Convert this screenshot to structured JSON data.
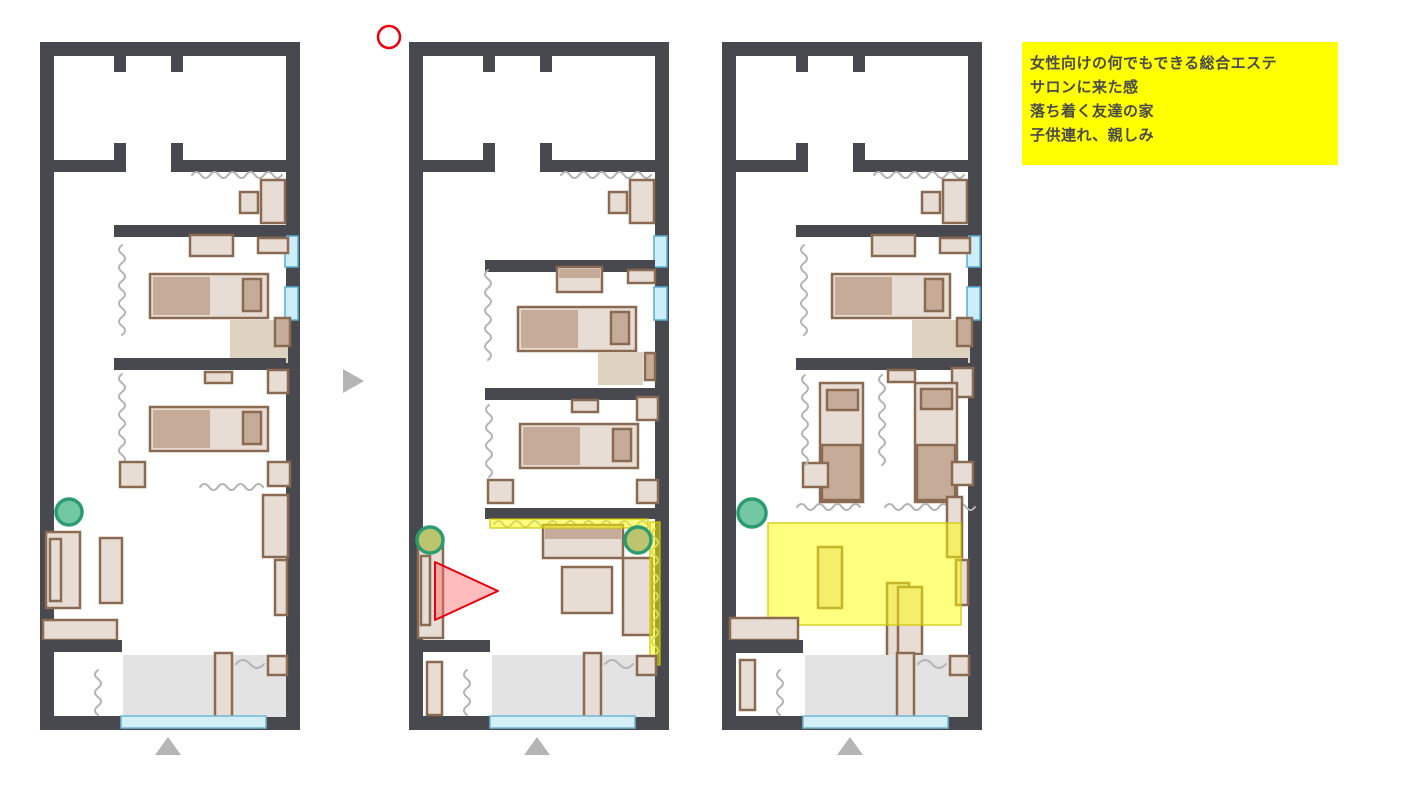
{
  "annotation_note": {
    "lines": [
      "女性向けの何でもできる総合エステ",
      "サロンに来た感",
      "落ち着く友達の家",
      "子供連れ、親しみ"
    ]
  },
  "markers": {
    "red_circle": "red-circle-marker",
    "flow_arrow": "flow-arrow-right-icon",
    "pink_arrow": "pink-direction-arrow",
    "plant": "plant-marker",
    "entrance_arrow": "entrance-arrow-marker",
    "highlight": "yellow-highlight-area"
  },
  "colors": {
    "wall": "#47494f",
    "furniture_fill": "#e8ddd4",
    "furniture_stroke": "#8a6b52",
    "furniture_dark": "#c6ac98",
    "mat": "#ddd3c0",
    "window_fill": "#cdedf8",
    "window_stroke": "#56aed2",
    "entrance_gray": "#e3e3e3",
    "entry_blue_fill": "#d4eef8",
    "entry_blue_stroke": "#6fb9d6",
    "squiggle": "#b3b3b3",
    "plant_fill": "#74c7a3",
    "plant_stroke": "#2b9c72",
    "plant2_fill": "#bcc46d",
    "highlight_yellow": "#ffff00",
    "highlight_stroke": "#d0c400",
    "red": "#e8000d",
    "pink_arrow_fill": "#ff6a6a",
    "gray_arrow": "#b5b5b5",
    "note_bg": "#ffff00",
    "note_text": "#4a4a4a"
  }
}
